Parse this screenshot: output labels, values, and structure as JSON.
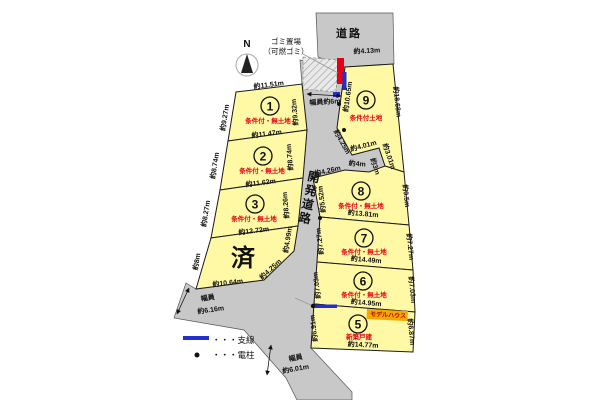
{
  "colors": {
    "plot_fill": "#fff9a6",
    "road_fill": "#c8c8c8",
    "status_red": "#e60012",
    "wire_blue": "#2230cf",
    "garbage_red": "#e60012",
    "tag_orange": "#f5a800"
  },
  "compass": {
    "label": "N"
  },
  "garbage": {
    "line1": "ゴミ置場",
    "line2": "（可燃ゴミ）"
  },
  "roads": {
    "top_label": "道路",
    "top_width": "約4.13m",
    "dev_label": "開発道路",
    "dev_width": "幅員約6m",
    "west_width_line1": "幅員",
    "west_width_line2": "約6.16m",
    "south_width_line1": "幅員",
    "south_width_line2": "約6.01m"
  },
  "legend": {
    "wire": "・・・支線",
    "pole": "・・・電柱"
  },
  "plots": {
    "p1": {
      "num": "1",
      "status": "条件付・無土地",
      "top": "約11.51m",
      "left": "約9.27m",
      "right": "約9.32m",
      "bottom": "約11.47m"
    },
    "p2": {
      "num": "2",
      "status": "条件付・無土地",
      "left": "約8.74m",
      "right": "約8.74m",
      "bottom": "約11.62m"
    },
    "p3": {
      "num": "3",
      "status": "条件付・無土地",
      "left": "約8.27m",
      "right": "約8.26m",
      "bottom": "約12.72m"
    },
    "sold": {
      "label": "済",
      "left": "約8m",
      "right_upper": "約4.99m",
      "right_lower": "約4.25m",
      "bottom": "約10.64m"
    },
    "p9": {
      "num": "9",
      "status": "条件付土地",
      "left": "約10.65m",
      "right": "約18.68m",
      "edge_a": "約4.25m",
      "edge_b": "約4.01m",
      "edge_c": "約3.01m",
      "edge_d": "約3m",
      "edge_e": "約4m",
      "edge_f": "約4.26m"
    },
    "p8": {
      "num": "8",
      "status": "条件付・無土地",
      "left": "約5.52m",
      "right": "約9.5m",
      "bottom": "約13.81m"
    },
    "p7": {
      "num": "7",
      "status": "条件付・無土地",
      "left": "約7.27m",
      "right": "約7.27m",
      "bottom": "約14.49m"
    },
    "p6": {
      "num": "6",
      "status": "条件付・無土地",
      "left": "約7.03m",
      "right": "約7.03m",
      "bottom": "約14.95m"
    },
    "p5": {
      "num": "5",
      "status": "新築戸建",
      "tag": "モデルハウス",
      "left": "約6.91m",
      "right": "約6.87m",
      "bottom": "約14.77m"
    }
  }
}
